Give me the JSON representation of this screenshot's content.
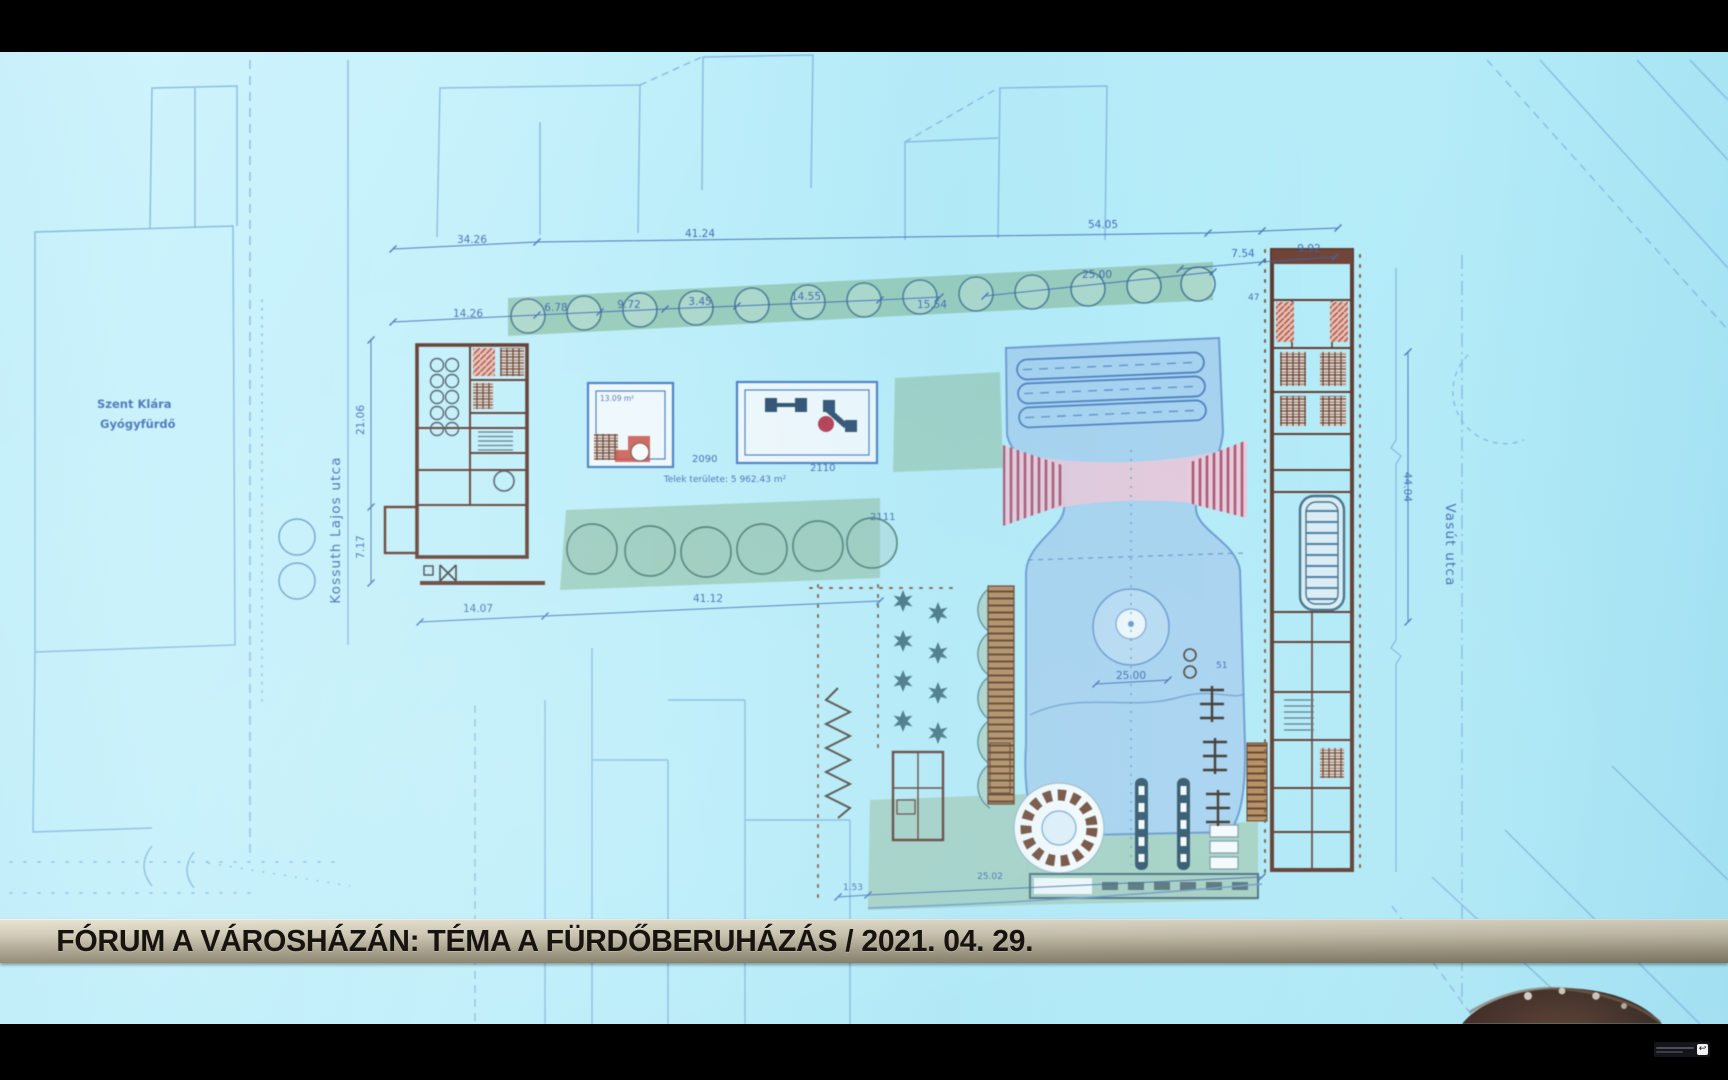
{
  "caption": {
    "text": "FÓRUM A VÁROSHÁZÁN: TÉMA A FÜRDŐBERUHÁZÁS / 2021. 04. 29."
  },
  "plan": {
    "streets": {
      "left": "Kossuth Lajos utca",
      "right": "Vasút utca"
    },
    "existing_building": {
      "line1": "Szent Klára",
      "line2": "Gyógyfürdő"
    },
    "parcel_numbers": {
      "p2090": "2090",
      "p2110": "2110",
      "p2111": "2111"
    },
    "area_note": "Telek területe: 5 962.43 m²",
    "dimensions": {
      "top": [
        "34.26",
        "41.24",
        "54.05",
        "7.54",
        "9.92"
      ],
      "row2": [
        "14.26",
        "6.78",
        "9.72",
        "3.45",
        "14.55",
        "15.54",
        "25.00"
      ],
      "left": [
        "21.06",
        "7.17"
      ],
      "bottom": [
        "14.07",
        "41.12"
      ],
      "bottom_edge": [
        "1.53",
        "25.02"
      ],
      "right": [
        "44.04"
      ],
      "pool": "25.00",
      "small": [
        "13.09 m²",
        "47",
        "51"
      ]
    }
  },
  "overlay": {
    "watermark_glyph": "↩"
  }
}
